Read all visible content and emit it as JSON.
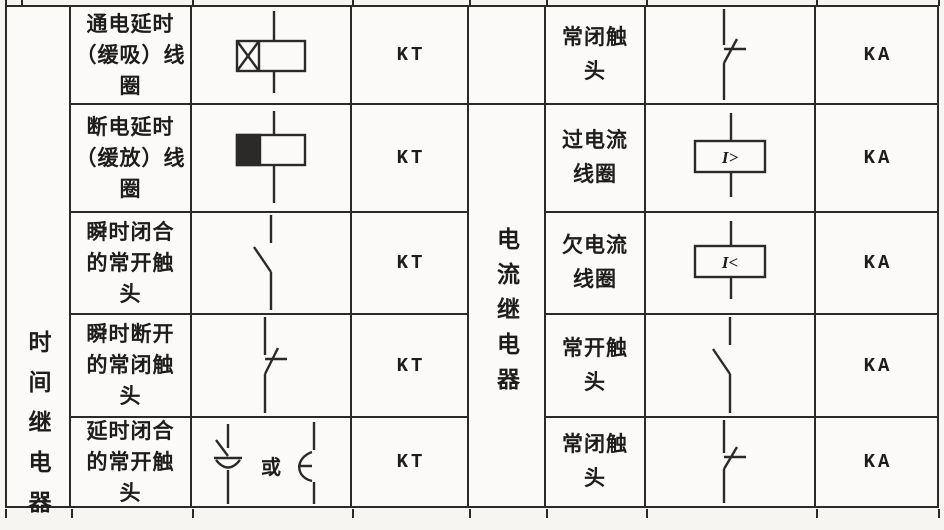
{
  "table": {
    "left": {
      "category": "时间继电器",
      "rows": [
        {
          "name": "通电延时\n（缓吸）线\n圈",
          "symbol": "coil-on-delay",
          "code": "KT"
        },
        {
          "name": "断电延时\n（缓放）线\n圈",
          "symbol": "coil-off-delay",
          "code": "KT"
        },
        {
          "name": "瞬时闭合\n的常开触\n头",
          "symbol": "no-contact",
          "code": "KT"
        },
        {
          "name": "瞬时断开\n的常闭触\n头",
          "symbol": "nc-contact",
          "code": "KT"
        },
        {
          "name": "延时闭合\n的常开触\n头",
          "symbol": "no-contact-delay-pair",
          "or_label": "或",
          "code": "KT"
        }
      ]
    },
    "right": {
      "category": "电流继电器",
      "rows": [
        {
          "name": "常闭触\n头",
          "symbol": "nc-contact",
          "code": "KA"
        },
        {
          "name": "过电流\n线圈",
          "symbol": "overcurrent-coil",
          "coil_label": "I>",
          "code": "KA"
        },
        {
          "name": "欠电流\n线圈",
          "symbol": "undercurrent-coil",
          "coil_label": "I<",
          "code": "KA"
        },
        {
          "name": "常开触\n头",
          "symbol": "no-contact",
          "code": "KA"
        },
        {
          "name": "常闭触\n头",
          "symbol": "nc-contact",
          "code": "KA"
        }
      ]
    }
  },
  "colors": {
    "line": "#2b2a28",
    "paper": "#f7f5f2",
    "text": "#1e1d1b"
  }
}
